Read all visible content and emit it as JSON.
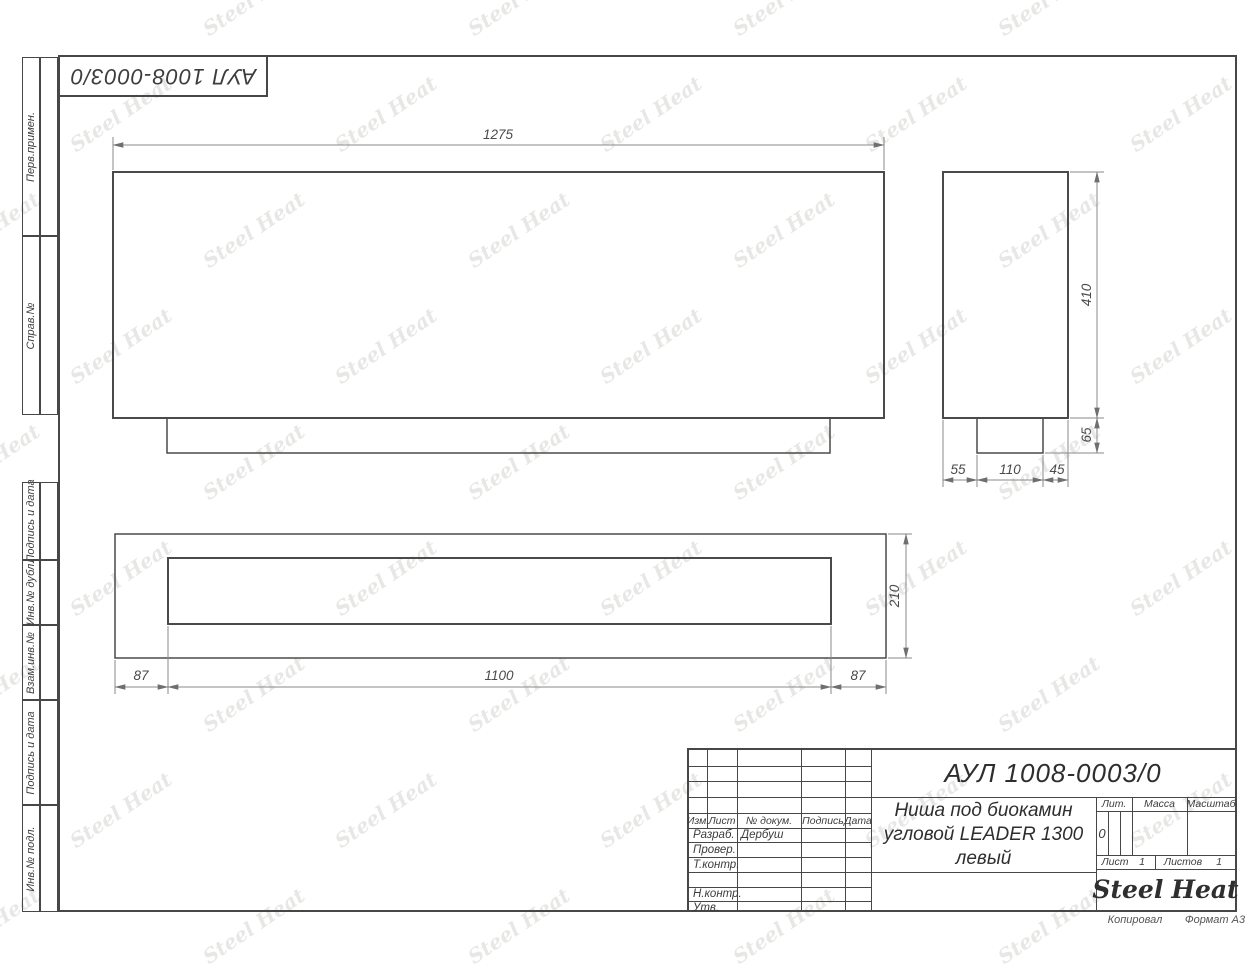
{
  "doc": {
    "number": "АУЛ 1008-0003/0",
    "title_line1": "Ниша под биокамин",
    "title_line2": "угловой LEADER 1300",
    "title_line3": "левый",
    "litera_label": "Лит.",
    "litera_value": "0",
    "mass_label": "Масса",
    "scale_label": "Масштаб",
    "sheet_label": "Лист",
    "sheet_value": "1",
    "sheets_label": "Листов",
    "sheets_value": "1"
  },
  "titleblock": {
    "col_headers": [
      "Изм.",
      "Лист",
      "№ докум.",
      "Подпись",
      "Дата"
    ],
    "rows": [
      {
        "label": "Разраб.",
        "value": "Дербуш"
      },
      {
        "label": "Провер.",
        "value": ""
      },
      {
        "label": "Т.контр.",
        "value": ""
      },
      {
        "label": "Н.контр.",
        "value": ""
      },
      {
        "label": "Утв.",
        "value": ""
      }
    ]
  },
  "margins": {
    "top_left_doc_number": "АУЛ 1008-0003/0",
    "left_labels": [
      "Перв.примен.",
      "Справ.№",
      "Подпись и дата",
      "Инв.№ дубл.",
      "Взам.инв.№",
      "Подпись и дата",
      "Инв.№ подл."
    ]
  },
  "footer": {
    "copied": "Копировал",
    "format": "Формат А3"
  },
  "logo": {
    "left": "Steel",
    "right": "Heat",
    "flame_color": "#e31e24"
  },
  "watermark": {
    "text": "Steel Heat"
  },
  "drawing": {
    "front_view": {
      "width_dim": "1275"
    },
    "side_view": {
      "height_dim": "410",
      "foot_height_dim": "65",
      "bottom_dims": [
        "55",
        "110",
        "45"
      ]
    },
    "bottom_view": {
      "left_margin_dim": "87",
      "opening_dim": "1100",
      "right_margin_dim": "87",
      "depth_dim": "210"
    }
  }
}
